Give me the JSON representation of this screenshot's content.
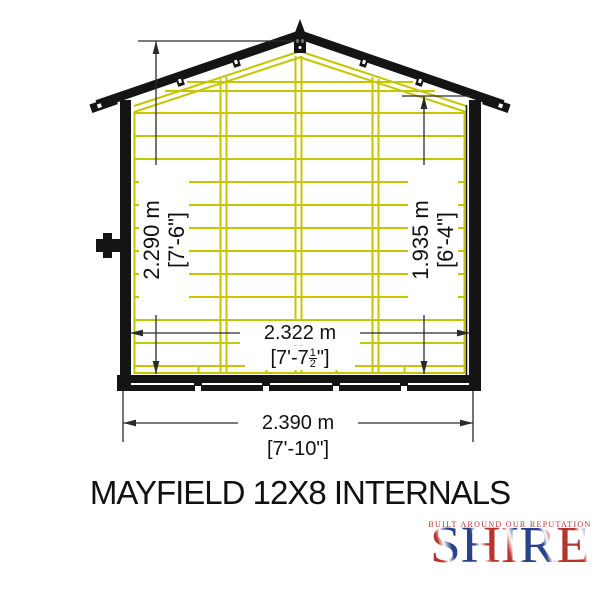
{
  "title": "MAYFIELD 12X8 INTERNALS",
  "diagram": {
    "name": "shed front internal elevation",
    "dimensions": {
      "ridge_height": {
        "metric": "2.290 m",
        "imperial": "[7'-6\"]"
      },
      "eaves_height": {
        "metric": "1.935 m",
        "imperial": "[6'-4\"]"
      },
      "internal_width": {
        "metric": "2.322 m",
        "imperial_prefix": "[7'-7",
        "fraction_numerator": "1",
        "fraction_denominator": "2",
        "imperial_suffix": "\"]"
      },
      "overall_width": {
        "metric": "2.390 m",
        "imperial": "[7'-10\"]"
      }
    }
  },
  "logo": {
    "brand": "SHIRE",
    "tagline": "BUILT AROUND OUR REPUTATION"
  },
  "colors": {
    "background": "#ffffff",
    "outline": "#141414",
    "cladding": "#c5c500",
    "dim_lines": "#2a2a2a",
    "text": "#111111",
    "logo_red": "#b5342e",
    "logo_blue": "#28418a"
  }
}
